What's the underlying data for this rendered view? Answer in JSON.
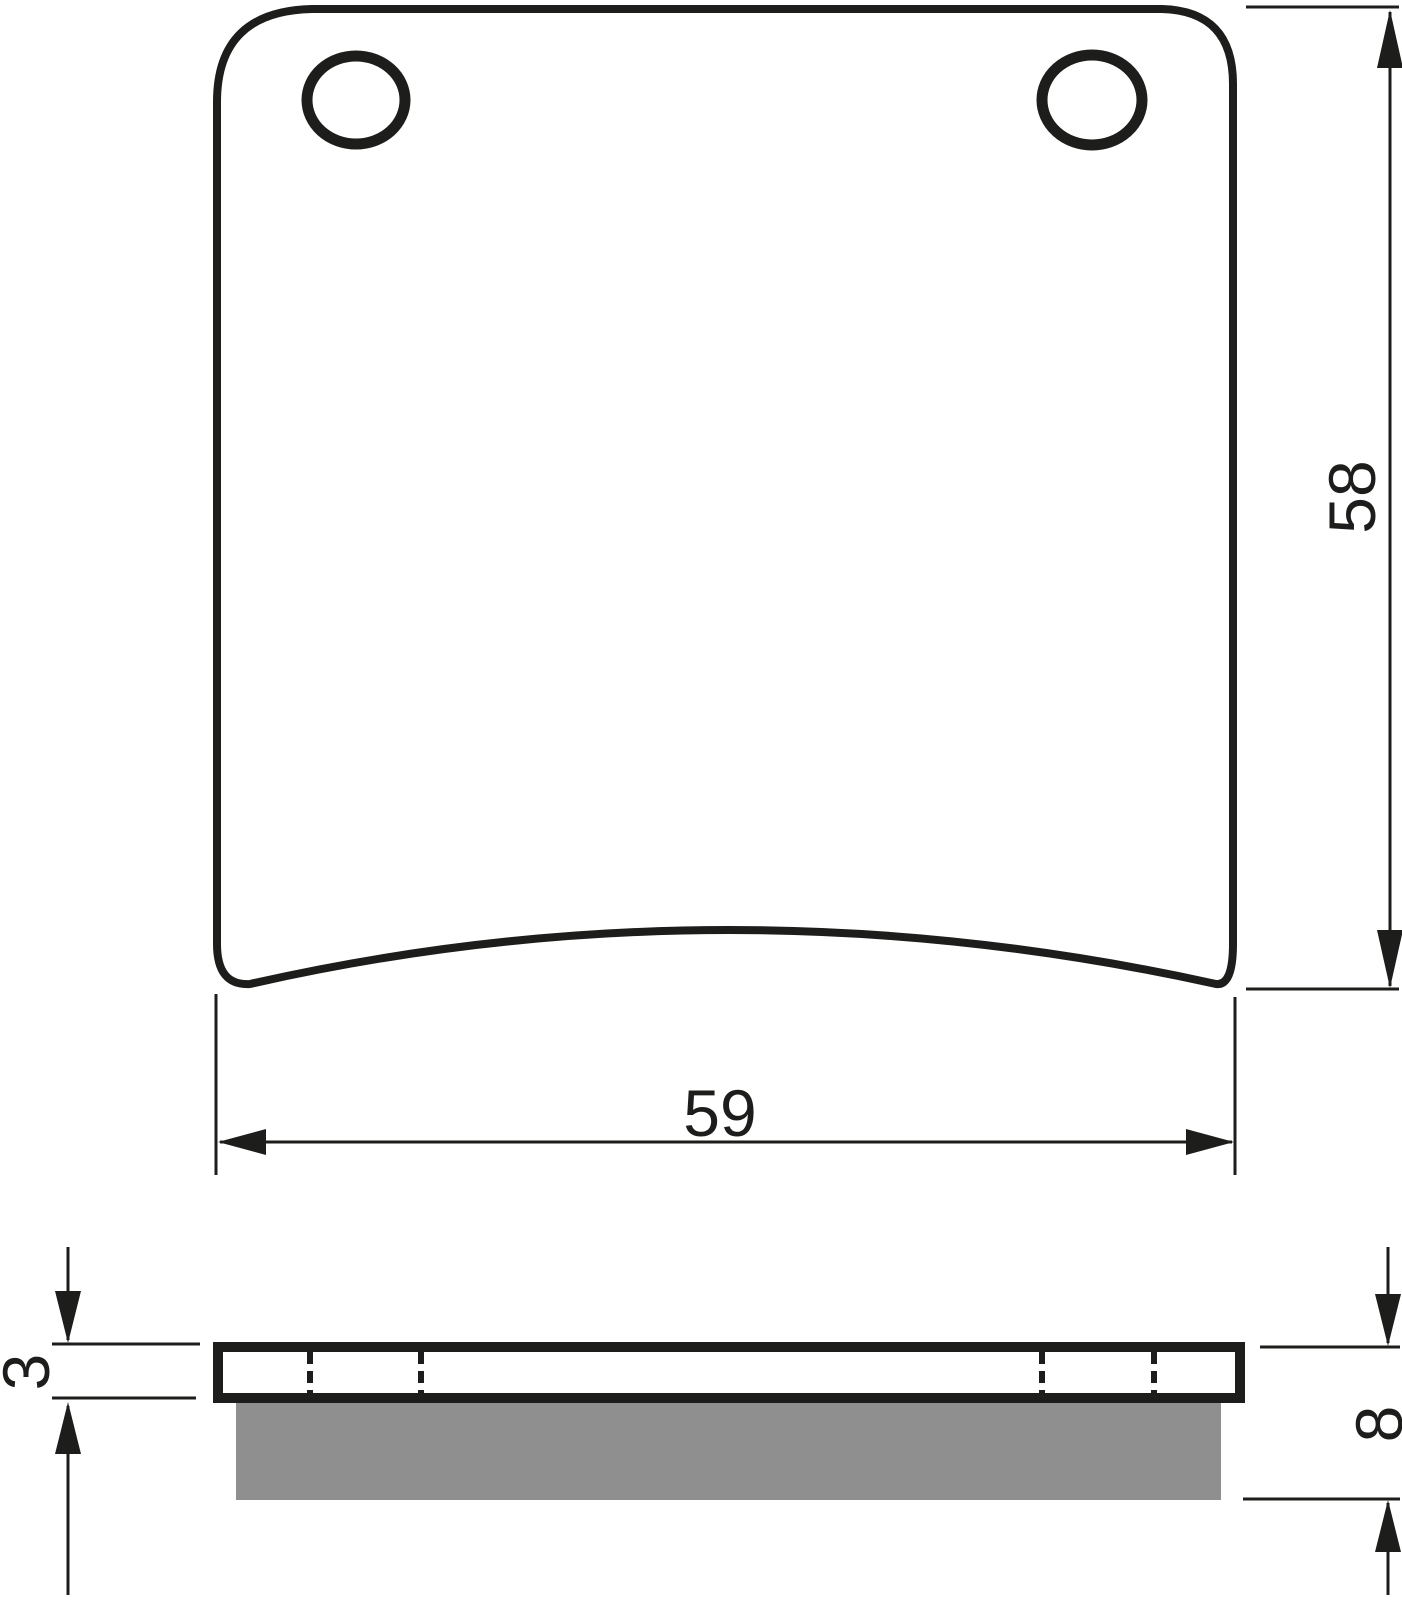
{
  "dims": {
    "pad_height": "58",
    "pad_width": "59",
    "plate_thickness": "3",
    "total_thickness": "8"
  },
  "colors": {
    "ink": "#1d1d1b",
    "friction": "#8f8f8f",
    "paper": "#ffffff"
  }
}
